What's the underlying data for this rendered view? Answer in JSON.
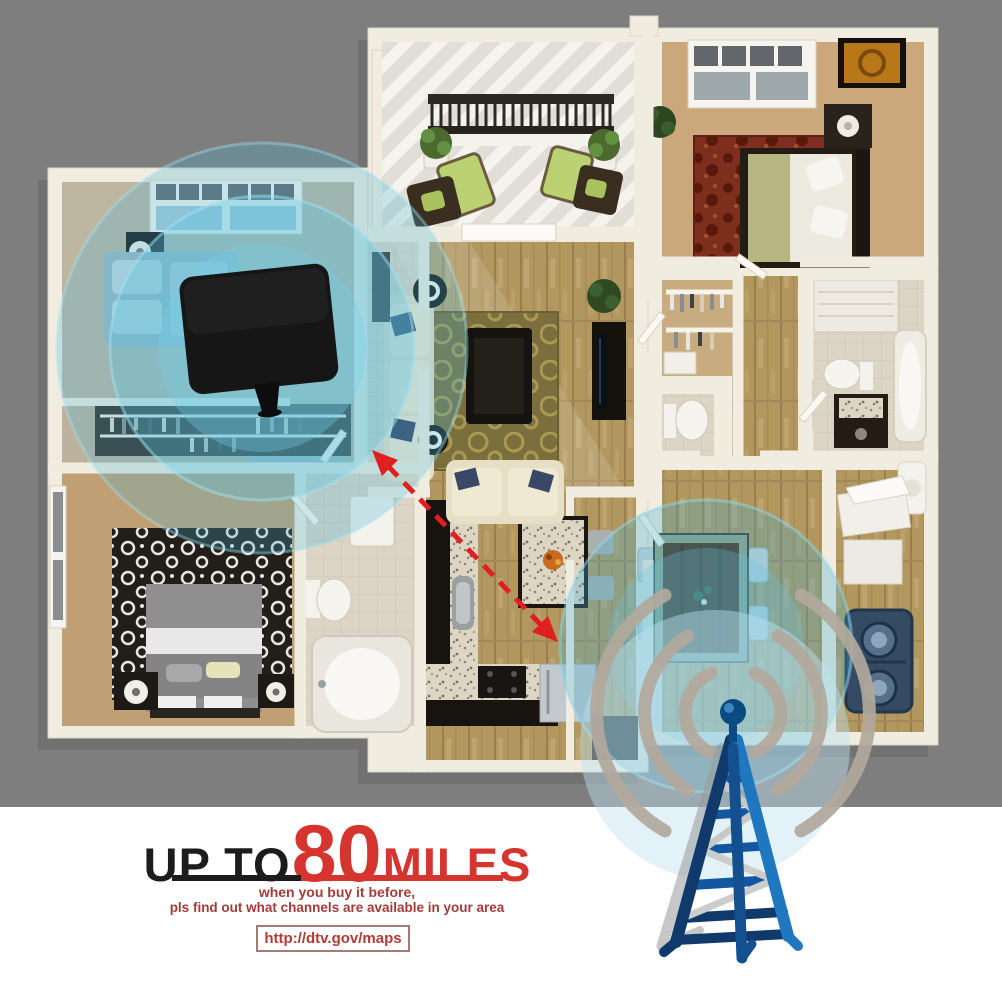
{
  "promo": {
    "prefix": "UP TO",
    "value": "80",
    "unit": "MILES",
    "note_line1": "when you buy it before,",
    "note_line2": "pls find out what channels are available in your area",
    "url": "http://dtv.gov/maps"
  },
  "colors": {
    "background_top": "#7e7e7e",
    "background_bottom": "#ffffff",
    "accent_red": "#d6352f",
    "headline_black": "#1c1c1c",
    "note_red": "#a33b38",
    "url_red": "#b23b34",
    "signal_glow_blue": "#57c2e0",
    "tower_blue_dark": "#0f3a6b",
    "tower_blue_light": "#1f77c0",
    "signal_wave_gray": "#b3a99d",
    "antenna_black": "#141414",
    "wall_cream": "#f1ece0"
  },
  "icons": [
    {
      "name": "flat-antenna-icon"
    },
    {
      "name": "broadcast-tower-icon"
    },
    {
      "name": "signal-waves-icon"
    },
    {
      "name": "range-arrow-icon"
    },
    {
      "name": "signal-glow-icon"
    }
  ]
}
